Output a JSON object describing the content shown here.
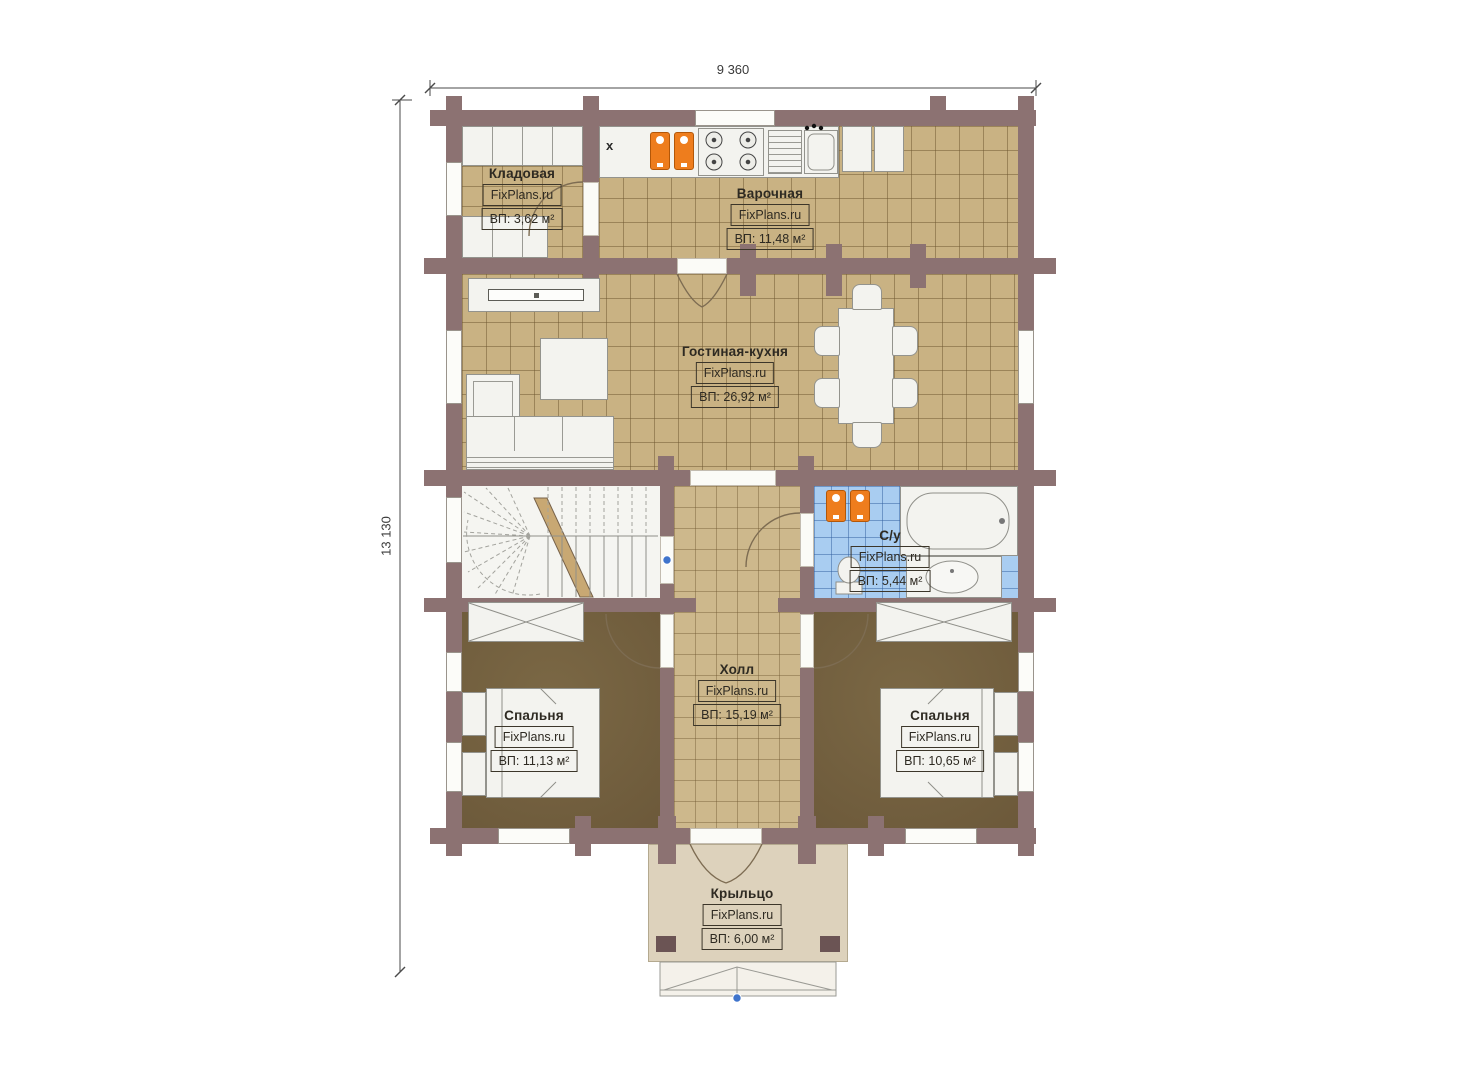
{
  "plan": {
    "dimensions": {
      "width": "9 360",
      "depth": "13 130"
    },
    "rooms": [
      {
        "key": "storage",
        "name": "Кладовая",
        "brand": "FixPlans.ru",
        "area": "ВП: 3,62 м²"
      },
      {
        "key": "cooking",
        "name": "Варочная",
        "brand": "FixPlans.ru",
        "area": "ВП: 11,48 м²"
      },
      {
        "key": "living",
        "name": "Гостиная-кухня",
        "brand": "FixPlans.ru",
        "area": "ВП: 26,92 м²"
      },
      {
        "key": "bathroom",
        "name": "С/у",
        "brand": "FixPlans.ru",
        "area": "ВП: 5,44 м²"
      },
      {
        "key": "hall",
        "name": "Холл",
        "brand": "FixPlans.ru",
        "area": "ВП: 15,19 м²"
      },
      {
        "key": "bedroom_left",
        "name": "Спальня",
        "brand": "FixPlans.ru",
        "area": "ВП: 11,13 м²"
      },
      {
        "key": "bedroom_right",
        "name": "Спальня",
        "brand": "FixPlans.ru",
        "area": "ВП: 10,65 м²"
      },
      {
        "key": "porch",
        "name": "Крыльцо",
        "brand": "FixPlans.ru",
        "area": "ВП: 6,00 м²"
      }
    ],
    "symbols": {
      "vent_mark": "х"
    },
    "colors": {
      "wall": "#8c7272",
      "floor_tile": "#c9b283",
      "bath_tile": "#a9cdf1",
      "bedroom_floor": "#72603f",
      "porch_floor": "#ddd2bc",
      "accent_orange": "#ee7d1d",
      "marker_blue": "#3f74cc"
    }
  }
}
